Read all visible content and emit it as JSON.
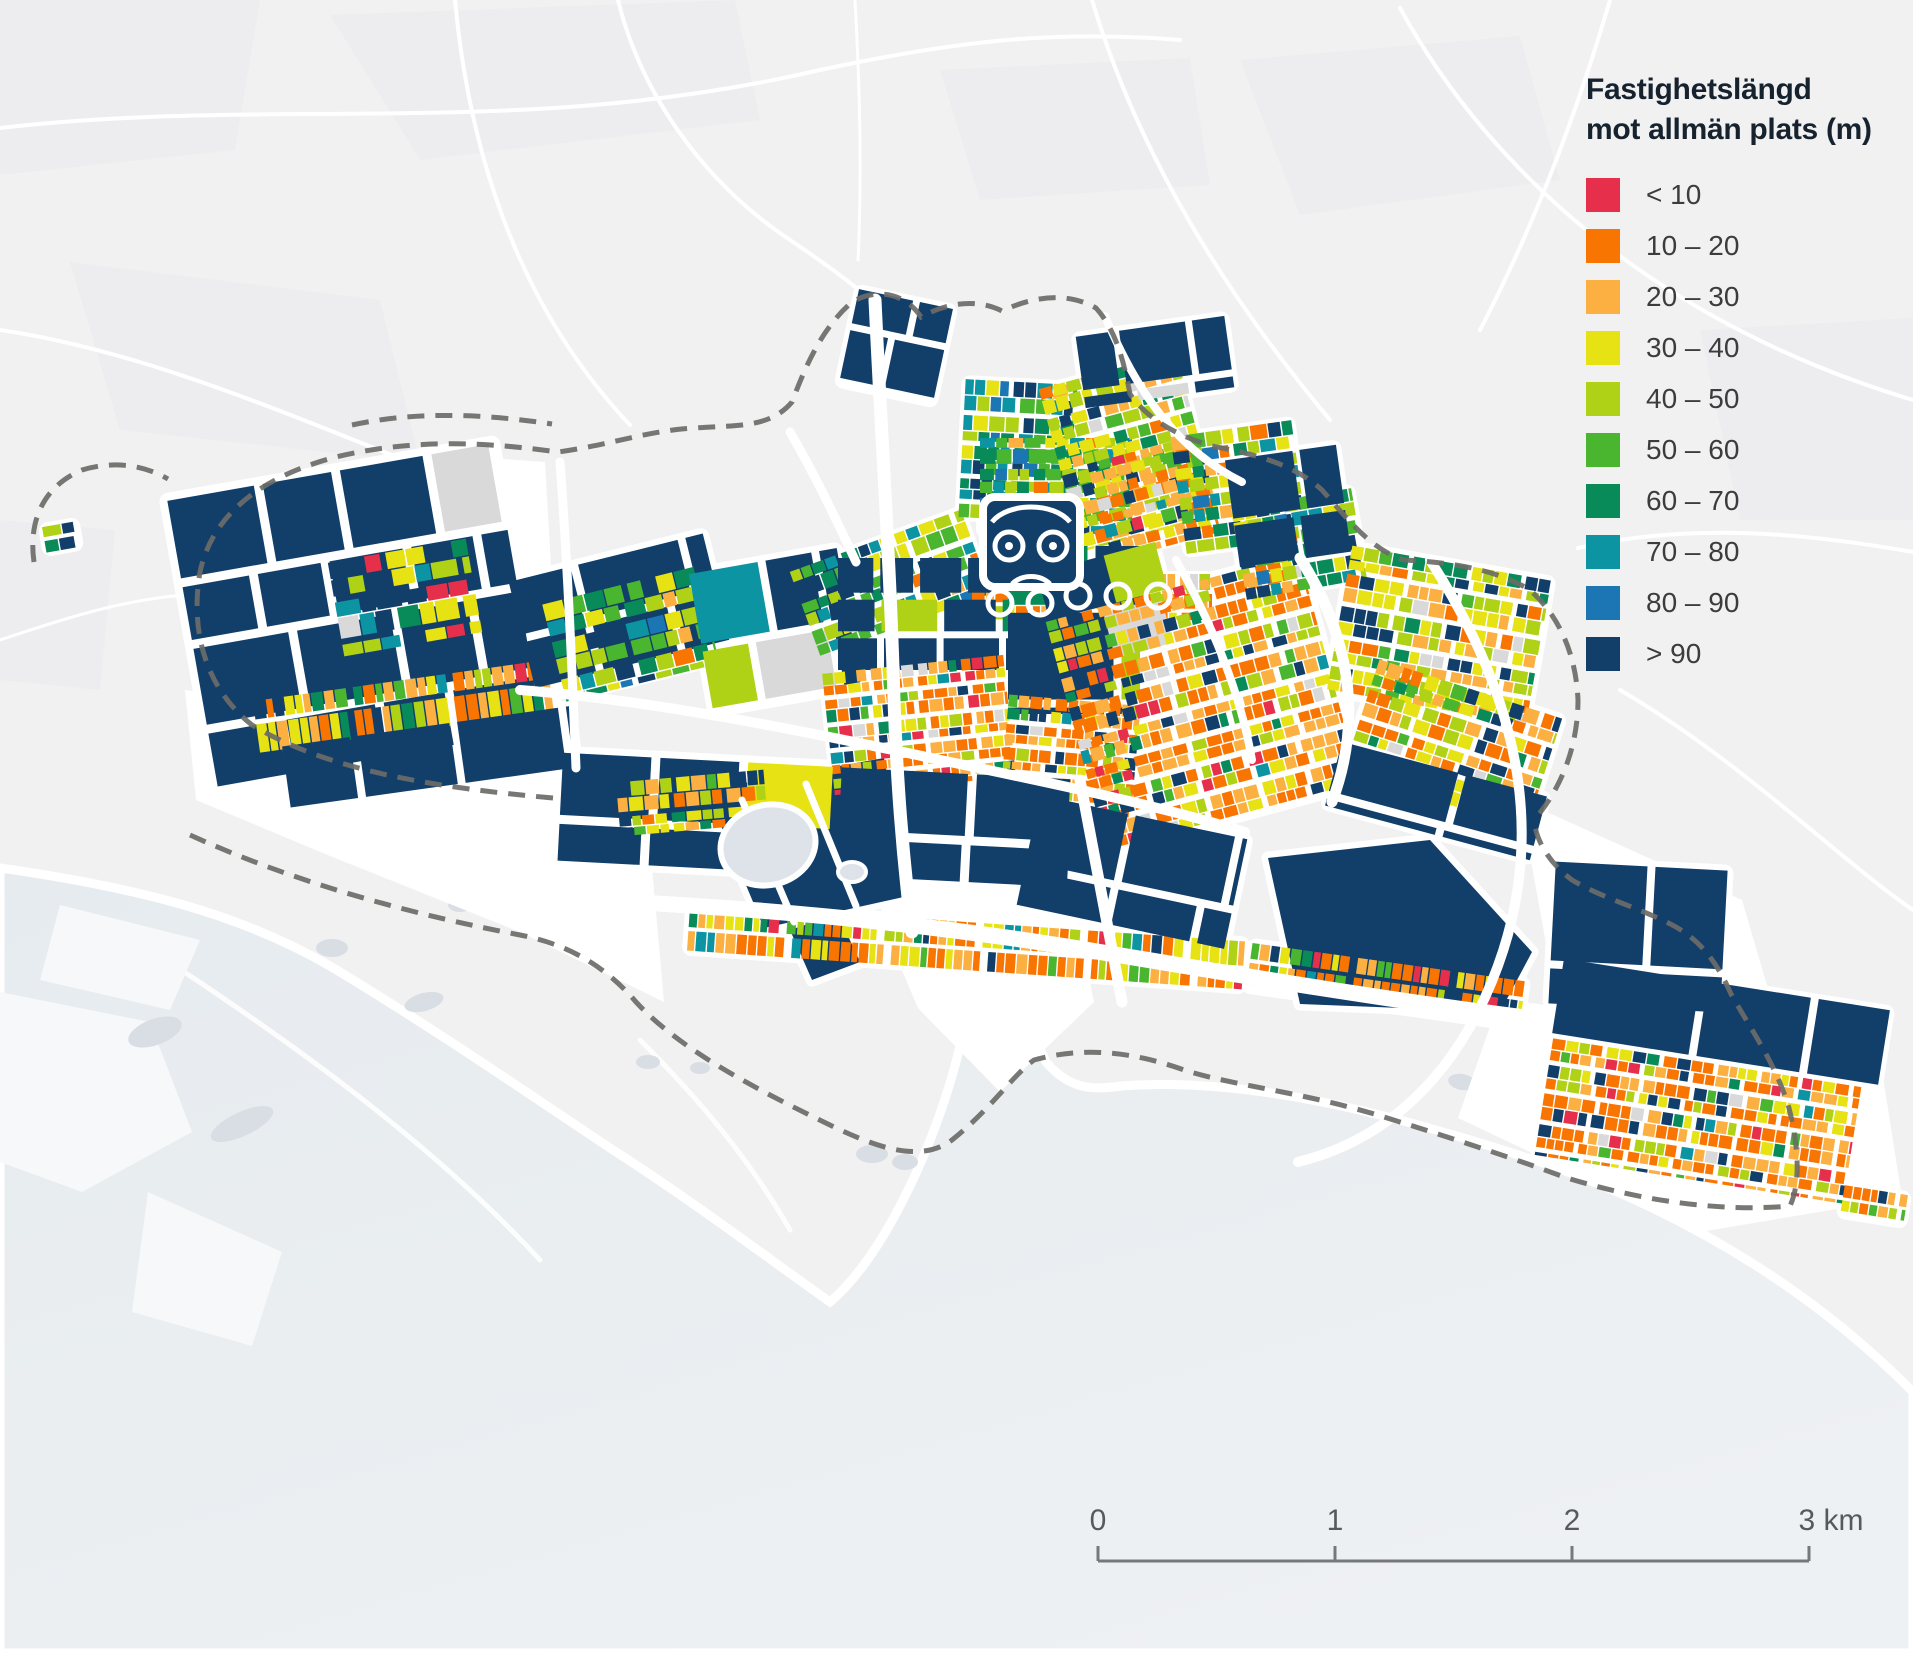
{
  "legend": {
    "title_lines": [
      "Fastighetslängd",
      "mot allmän plats (m)"
    ],
    "items": [
      {
        "label": "< 10",
        "color": "#e6304b"
      },
      {
        "label": "10 – 20",
        "color": "#f97502"
      },
      {
        "label": "20 – 30",
        "color": "#fbb041"
      },
      {
        "label": "30 – 40",
        "color": "#e6e214"
      },
      {
        "label": "40 – 50",
        "color": "#afd116"
      },
      {
        "label": "50 – 60",
        "color": "#4ab52e"
      },
      {
        "label": "60 – 70",
        "color": "#088b59"
      },
      {
        "label": "70 – 80",
        "color": "#0d94a3"
      },
      {
        "label": "80 – 90",
        "color": "#1d76b4"
      },
      {
        "label": "> 90",
        "color": "#123e6a"
      }
    ]
  },
  "scalebar": {
    "labels": [
      "0",
      "1",
      "2",
      "3 km"
    ],
    "x0": 1098,
    "x1": 1809,
    "y": 1561,
    "tick_h": 15,
    "label_y": 1530,
    "line_color": "#77787a",
    "text_color": "#58595c"
  },
  "map": {
    "colors": {
      "background": "#f1f1f2",
      "background_patch": "#ebebed",
      "road": "#ffffff",
      "water_a": "#e6ebef",
      "water_b": "#eef1f3",
      "pale_land": "#f7f8f9",
      "island": "#d8dee4",
      "lake": "#dde3e9",
      "boundary": "#6b6b68"
    },
    "category_colors": {
      "c10": "#e6304b",
      "c20": "#f97502",
      "c30": "#fbb041",
      "c40": "#e6e214",
      "c50": "#afd116",
      "c60": "#4ab52e",
      "c70": "#088b59",
      "c80": "#0d94a3",
      "c90": "#1d76b4",
      "cmax": "#123e6a",
      "gray": "#d9d9d9"
    },
    "mixes": {
      "navyBig": [
        [
          "cmax",
          86
        ],
        [
          "c40",
          3
        ],
        [
          "c50",
          3
        ],
        [
          "c70",
          2
        ],
        [
          "gray",
          4
        ],
        [
          "c80",
          2
        ]
      ],
      "orangeRes": [
        [
          "c20",
          34
        ],
        [
          "c30",
          22
        ],
        [
          "c40",
          9
        ],
        [
          "c10",
          5
        ],
        [
          "c50",
          8
        ],
        [
          "c60",
          4
        ],
        [
          "c70",
          3
        ],
        [
          "cmax",
          9
        ],
        [
          "gray",
          4
        ],
        [
          "c80",
          2
        ]
      ],
      "greenMix": [
        [
          "c50",
          20
        ],
        [
          "c60",
          18
        ],
        [
          "c70",
          13
        ],
        [
          "c80",
          11
        ],
        [
          "c40",
          12
        ],
        [
          "cmax",
          14
        ],
        [
          "c90",
          5
        ],
        [
          "c30",
          4
        ],
        [
          "c20",
          3
        ]
      ],
      "greenTeal": [
        [
          "c60",
          18
        ],
        [
          "c70",
          18
        ],
        [
          "c80",
          16
        ],
        [
          "c50",
          14
        ],
        [
          "cmax",
          14
        ],
        [
          "c90",
          8
        ],
        [
          "c40",
          8
        ],
        [
          "c30",
          4
        ]
      ],
      "yellowGreen": [
        [
          "c40",
          26
        ],
        [
          "c50",
          24
        ],
        [
          "c30",
          16
        ],
        [
          "c20",
          12
        ],
        [
          "c60",
          7
        ],
        [
          "cmax",
          9
        ],
        [
          "c70",
          4
        ],
        [
          "gray",
          2
        ]
      ],
      "ygOrange": [
        [
          "c40",
          20
        ],
        [
          "c50",
          16
        ],
        [
          "c30",
          20
        ],
        [
          "c20",
          20
        ],
        [
          "c60",
          6
        ],
        [
          "cmax",
          10
        ],
        [
          "c70",
          4
        ],
        [
          "c10",
          2
        ],
        [
          "gray",
          2
        ]
      ],
      "stripMix": [
        [
          "c20",
          26
        ],
        [
          "c30",
          24
        ],
        [
          "c40",
          16
        ],
        [
          "c10",
          6
        ],
        [
          "c50",
          8
        ],
        [
          "c60",
          6
        ],
        [
          "c70",
          6
        ],
        [
          "cmax",
          4
        ],
        [
          "c80",
          4
        ]
      ],
      "westMix": [
        [
          "c40",
          18
        ],
        [
          "c70",
          14
        ],
        [
          "c80",
          12
        ],
        [
          "c50",
          12
        ],
        [
          "cmax",
          30
        ],
        [
          "c10",
          4
        ],
        [
          "gray",
          10
        ]
      ]
    },
    "districts": [
      [
        "w-main",
        190,
        470,
        330,
        290,
        -10,
        "navyBig",
        78,
        66,
        1,
        1,
        9,
        9,
        8
      ],
      [
        "w-accent",
        335,
        550,
        140,
        95,
        -10,
        "westMix",
        20,
        19,
        3,
        2,
        6,
        6,
        2
      ],
      [
        "w-coast-strip",
        255,
        680,
        300,
        52,
        -8,
        "stripMix",
        9,
        24,
        9,
        1,
        7,
        5,
        6
      ],
      [
        "w-coast-navy",
        285,
        726,
        290,
        62,
        -8,
        "navyBig",
        95,
        58,
        1,
        1,
        8,
        8,
        6
      ],
      [
        "c-w-navy",
        520,
        556,
        200,
        118,
        -14,
        "navyBig",
        84,
        52,
        1,
        1,
        8,
        8,
        6
      ],
      [
        "c-green",
        552,
        584,
        158,
        100,
        -14,
        "greenMix",
        16,
        15,
        4,
        2,
        6,
        6,
        2
      ],
      [
        "c-w2-navy",
        700,
        560,
        150,
        140,
        -10,
        "navyBig",
        64,
        62,
        1,
        1,
        8,
        8,
        6
      ],
      [
        "nw-cluster",
        800,
        538,
        182,
        92,
        -20,
        "greenMix",
        13,
        13,
        4,
        2,
        6,
        6,
        4
      ],
      [
        "n-green1",
        962,
        382,
        112,
        138,
        3,
        "greenTeal",
        12,
        12,
        4,
        2,
        5,
        5,
        4
      ],
      [
        "n-green2",
        980,
        438,
        152,
        96,
        0,
        "greenMix",
        13,
        12,
        4,
        2,
        5,
        5,
        4
      ],
      [
        "n-yg-east",
        1058,
        368,
        142,
        168,
        -15,
        "yellowGreen",
        13,
        12,
        4,
        2,
        5,
        5,
        4
      ],
      [
        "n-orange",
        1098,
        448,
        112,
        100,
        -15,
        "orangeRes",
        11,
        11,
        4,
        2,
        5,
        5,
        2
      ],
      [
        "n-mixed2",
        1178,
        428,
        122,
        118,
        -8,
        "greenMix",
        13,
        12,
        4,
        2,
        5,
        5,
        4
      ],
      [
        "n-navy1",
        1080,
        326,
        150,
        72,
        -8,
        "navyBig",
        52,
        44,
        1,
        1,
        7,
        7,
        5
      ],
      [
        "n-navy2",
        848,
        298,
        96,
        96,
        12,
        "navyBig",
        46,
        42,
        1,
        1,
        7,
        7,
        5
      ],
      [
        "rings-w",
        972,
        584,
        106,
        40,
        0,
        "orangeRes",
        10,
        15,
        5,
        1,
        5,
        4,
        3
      ],
      [
        "rings-e",
        1062,
        574,
        150,
        46,
        0,
        "orangeRes",
        10,
        16,
        5,
        1,
        5,
        4,
        3
      ],
      [
        "c-navy-grid",
        838,
        558,
        172,
        112,
        0,
        "navyBig",
        44,
        40,
        1,
        1,
        7,
        7,
        6
      ],
      [
        "c-navy-big",
        1008,
        546,
        132,
        168,
        0,
        "navyBig",
        95,
        78,
        1,
        1,
        8,
        8,
        6
      ],
      [
        "c-orange1",
        828,
        664,
        182,
        122,
        -6,
        "orangeRes",
        10,
        10,
        4,
        2,
        5,
        5,
        4
      ],
      [
        "c-orange2",
        1004,
        700,
        132,
        112,
        5,
        "orangeRes",
        10,
        10,
        4,
        2,
        5,
        5,
        4
      ],
      [
        "e-navy-wedge",
        1048,
        556,
        122,
        102,
        -15,
        "navyBig",
        56,
        48,
        1,
        1,
        7,
        7,
        5
      ],
      [
        "e-orange",
        1072,
        584,
        262,
        238,
        -15,
        "orangeRes",
        11,
        11,
        4,
        2,
        6,
        6,
        6
      ],
      [
        "ne-mixed",
        1238,
        498,
        122,
        92,
        -10,
        "greenMix",
        13,
        12,
        4,
        2,
        5,
        5,
        4
      ],
      [
        "ne-navy",
        1232,
        452,
        112,
        108,
        -8,
        "navyBig",
        54,
        50,
        1,
        1,
        7,
        7,
        5
      ],
      [
        "fe-lobe1",
        1338,
        562,
        202,
        148,
        10,
        "yellowGreen",
        12,
        12,
        4,
        2,
        5,
        5,
        5
      ],
      [
        "fe-lobe2",
        1356,
        686,
        192,
        122,
        18,
        "ygOrange",
        12,
        12,
        4,
        2,
        5,
        5,
        5
      ],
      [
        "fe-navy-s",
        1330,
        768,
        212,
        66,
        15,
        "navyBig",
        98,
        60,
        1,
        1,
        8,
        8,
        5
      ],
      [
        "s-navy-band",
        560,
        766,
        510,
        108,
        3,
        "navyBig",
        112,
        64,
        1,
        1,
        9,
        9,
        7
      ],
      [
        "s-strip1",
        688,
        922,
        556,
        48,
        4,
        "stripMix",
        8,
        21,
        10,
        1,
        8,
        4,
        5
      ],
      [
        "s-strip2",
        1248,
        962,
        276,
        46,
        8,
        "stripMix",
        8,
        20,
        10,
        1,
        8,
        4,
        5
      ],
      [
        "port-navy",
        1026,
        816,
        212,
        112,
        12,
        "navyBig",
        90,
        66,
        1,
        1,
        8,
        8,
        6
      ],
      [
        "fe-navy-big",
        1552,
        866,
        172,
        142,
        3,
        "navyBig",
        92,
        80,
        1,
        1,
        8,
        8,
        6
      ],
      [
        "se-navy-n",
        1556,
        984,
        330,
        76,
        9,
        "navyBig",
        120,
        66,
        1,
        1,
        8,
        8,
        5
      ],
      [
        "se-orange",
        1542,
        1062,
        312,
        118,
        9,
        "orangeRes",
        10,
        12,
        4,
        2,
        5,
        5,
        5
      ],
      [
        "tail",
        1842,
        1190,
        64,
        30,
        9,
        "stripMix",
        8,
        14,
        6,
        1,
        5,
        3,
        4
      ],
      [
        "lake-yg",
        618,
        776,
        148,
        54,
        -5,
        "yellowGreen",
        12,
        12,
        4,
        2,
        5,
        5,
        4
      ],
      [
        "w-far-dot",
        44,
        524,
        34,
        26,
        -10,
        "westMix",
        15,
        12,
        2,
        1,
        4,
        4,
        4
      ]
    ],
    "polygons": [
      [
        "cmax",
        "706,790 884,758 908,896 764,928"
      ],
      [
        "cmax",
        "790,930 838,914 860,962 812,980"
      ],
      [
        "cmax",
        "1268,858 1430,840 1532,952 1500,1012 1300,1004"
      ]
    ],
    "white_land": [
      "215,565 300,482 420,453 545,462 558,688 520,700 345,738 242,712",
      "185,690 560,742 648,822 664,1002 520,932 330,856 196,800",
      "872,852 1062,842 1094,1002 1000,1092 918,1008 884,928",
      "1500,998 1880,1058 1902,1198 1700,1232 1458,1118",
      "1520,800 1742,900 1800,1098 1698,1098 1558,1010"
    ],
    "bg_patches": [
      "0,0 260,0 235,150 0,175",
      "330,15 735,0 760,120 420,160",
      "1240,60 1520,36 1560,180 1300,215",
      "70,262 380,300 420,462 120,430",
      "1700,330 1913,318 1913,520 1740,520",
      "940,70 1190,58 1210,185 980,200",
      "0,520 115,530 100,690 0,680"
    ],
    "bg_roads": [
      [
        "M 0,128 C 280,96 520,140 820,70 C 960,40 1060,30 1180,40",
        4
      ],
      [
        "M 455,0 C 468,140 512,300 630,425",
        4
      ],
      [
        "M 1092,0 C 1140,160 1230,300 1330,420",
        4
      ],
      [
        "M 1400,8 C 1500,190 1680,330 1913,400",
        4
      ],
      [
        "M 0,330 C 150,352 300,420 430,470",
        4
      ],
      [
        "M 1578,548 C 1700,520 1820,536 1913,552",
        4
      ],
      [
        "M 1620,690 C 1740,760 1840,860 1913,910",
        4
      ],
      [
        "M 618,0 C 640,90 700,180 790,240 C 880,300 920,340 930,380",
        4
      ],
      [
        "M 1610,0 C 1575,120 1532,230 1480,330",
        4
      ],
      [
        "M 0,640 C 60,620 120,600 185,595",
        3
      ],
      [
        "M 855,0 C 860,90 862,180 858,260",
        3
      ]
    ],
    "roads_over": [
      [
        "M 875,300 C 882,450 890,560 894,700 C 897,780 902,850 912,932",
        13
      ],
      [
        "M 545,898 C 700,904 900,918 1100,952 C 1250,977 1400,1002 1545,1020",
        16
      ],
      [
        "M 520,690 C 650,700 800,730 950,762 C 1060,785 1160,806 1245,832",
        10
      ],
      [
        "M 1300,558 C 1352,640 1362,722 1332,802",
        11
      ],
      [
        "M 1105,316 C 1140,400 1182,452 1242,482",
        8
      ],
      [
        "M 1430,560 C 1520,700 1558,852 1478,1012 C 1438,1090 1378,1142 1298,1162",
        10
      ],
      [
        "M 1080,780 L 1122,1002",
        11
      ],
      [
        "M 742,800 L 794,922",
        7
      ],
      [
        "M 806,784 L 856,906",
        7
      ],
      [
        "M 560,462 C 568,570 572,670 576,768",
        9
      ],
      [
        "M 790,432 C 818,480 840,528 856,562",
        9
      ],
      [
        "M 1176,560 C 1210,620 1240,690 1252,760",
        8
      ]
    ],
    "water_path": "M 0,868 C 140,888 240,914 330,966 C 430,1026 520,1088 610,1148 C 700,1206 762,1254 830,1302 C 882,1258 932,1152 956,1062 C 966,1022 976,986 990,960 C 1010,986 1032,1030 1046,1062 C 1070,1090 1092,1090 1122,1086 C 1252,1076 1402,1116 1552,1166 C 1702,1220 1822,1300 1913,1392 L 1913,1653 L 0,1653 Z",
    "water_streaks": [
      "M 120,930 C 260,1020 420,1130 540,1260",
      "M 640,1040 C 700,1100 750,1160 790,1230"
    ],
    "pale_land": [
      "0,992 150,1022 192,1132 82,1192 0,1162",
      "148,1192 282,1252 252,1346 132,1312",
      "60,905 200,940 170,1010 40,980"
    ],
    "islands": [
      [
        155,
        1032,
        28,
        13,
        -20
      ],
      [
        242,
        1124,
        34,
        12,
        -25
      ],
      [
        332,
        948,
        16,
        9,
        0
      ],
      [
        424,
        1002,
        20,
        9,
        -15
      ],
      [
        648,
        1062,
        12,
        7,
        0
      ],
      [
        700,
        1068,
        10,
        6,
        0
      ],
      [
        872,
        1154,
        16,
        9,
        0
      ],
      [
        905,
        1162,
        13,
        8,
        0
      ],
      [
        460,
        905,
        12,
        7,
        0
      ],
      [
        1462,
        1082,
        14,
        8,
        10
      ],
      [
        1500,
        1094,
        11,
        7,
        10
      ]
    ],
    "lake": {
      "cx": 768,
      "cy": 845,
      "rx": 48,
      "ry": 40,
      "rot": -15,
      "cx2": 852,
      "cy2": 872,
      "rx2": 14,
      "ry2": 10
    },
    "owl": {
      "x": 983,
      "y": 497,
      "w": 97,
      "h": 90
    },
    "boundary_paths": [
      "M 553,798 C 440,788 330,772 252,725 C 205,688 190,630 200,572 C 212,515 260,478 332,458 C 415,437 492,443 558,452 C 610,445 650,430 695,428 C 738,425 770,428 792,402 C 806,365 822,328 852,302 C 878,287 906,294 921,317 C 946,303 976,298 1002,311 C 1032,297 1066,291 1096,308 C 1116,330 1124,362 1130,394 C 1148,420 1178,436 1212,446 C 1254,454 1294,464 1322,490 C 1350,522 1372,550 1404,560 C 1446,562 1494,568 1530,590 C 1560,617 1576,655 1578,700 C 1578,745 1562,788 1534,820",
      "M 190,835 C 300,885 420,916 520,935 C 562,943 602,962 636,1002 C 682,1052 762,1092 832,1126 C 882,1150 922,1162 952,1140 C 992,1108 1012,1076 1034,1060 C 1084,1046 1134,1052 1184,1070 C 1234,1086 1304,1092 1384,1117 C 1464,1142 1524,1162 1564,1177 C 1644,1202 1724,1212 1790,1206 C 1802,1180 1797,1140 1789,1108 C 1776,1064 1750,1028 1731,994 C 1716,960 1700,941 1676,927 C 1646,910 1606,900 1572,880 C 1548,862 1536,840 1534,820",
      "M 352,425 C 420,410 492,415 552,424",
      "M 34,562 C 28,520 44,486 82,470 C 112,461 142,464 168,479"
    ]
  }
}
